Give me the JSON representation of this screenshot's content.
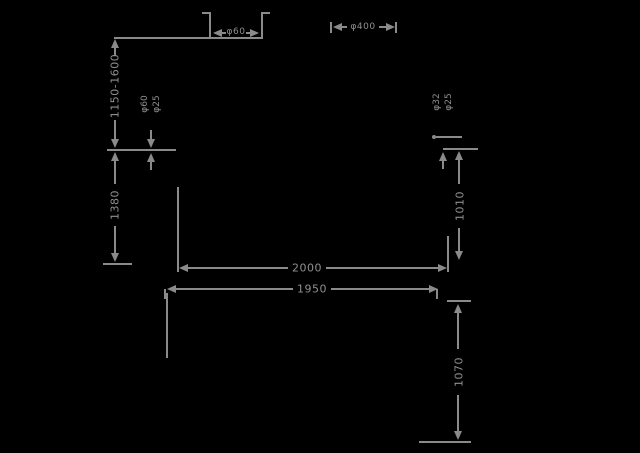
{
  "drawing": {
    "background": "#000000",
    "line_color": "#8a8a8a",
    "text_color": "#8f8f8f",
    "labels": {
      "top_detail_diameter": "φ60",
      "top_right_diameter": "φ400",
      "height_range": "1150-1600",
      "left_lower_height": "1380",
      "left_annotation_line1": "φ60",
      "left_annotation_line2": "φ25",
      "right_annotation_line1": "φ32",
      "right_annotation_line2": "φ25",
      "right_middle_height": "1010",
      "overall_width": "2000",
      "base_width": "1950",
      "base_depth": "1070"
    }
  }
}
